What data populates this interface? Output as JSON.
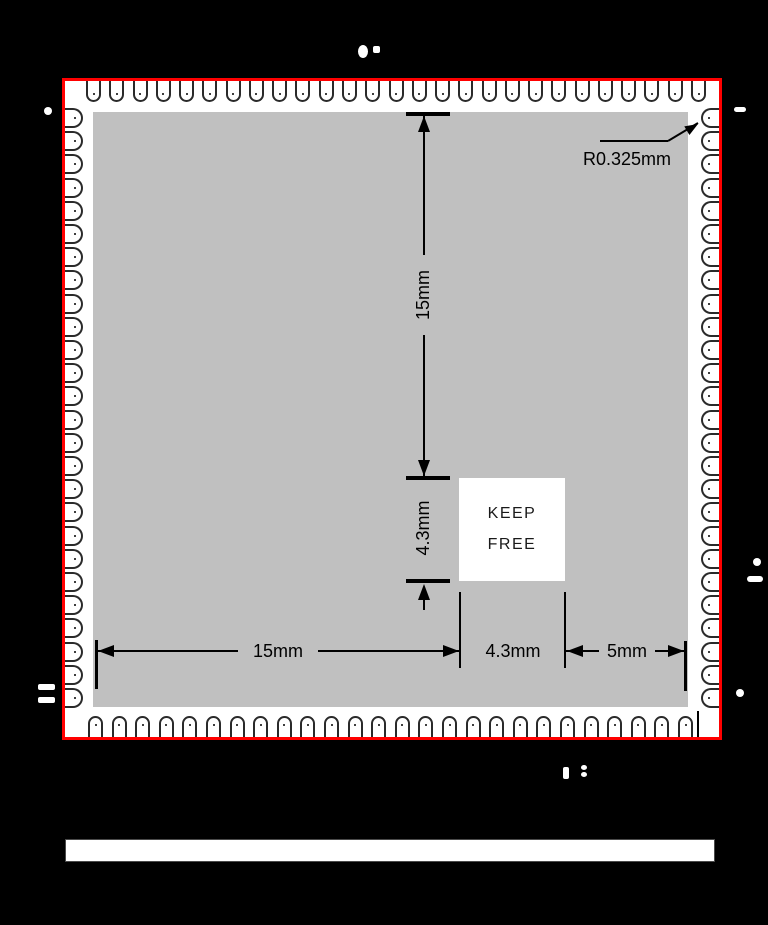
{
  "module": {
    "keep_free": {
      "line1": "KEEP",
      "line2": "FREE"
    },
    "dimensions": {
      "vertical_height": "15mm",
      "vertical_keepout": "4.3mm",
      "horizontal_width": "15mm",
      "horizontal_keepout": "4.3mm",
      "horizontal_edge": "5mm",
      "pad_corner_radius": "R0.325mm"
    },
    "pads": {
      "top_count": 27,
      "bottom_count": 26,
      "left_count": 26,
      "right_count": 26
    }
  },
  "colors": {
    "background": "#000000",
    "module_outline_red": "#ff0000",
    "pcb_gray": "#c0c0c0",
    "pad_fill": "#ffffff",
    "dimension_black": "#000000"
  }
}
